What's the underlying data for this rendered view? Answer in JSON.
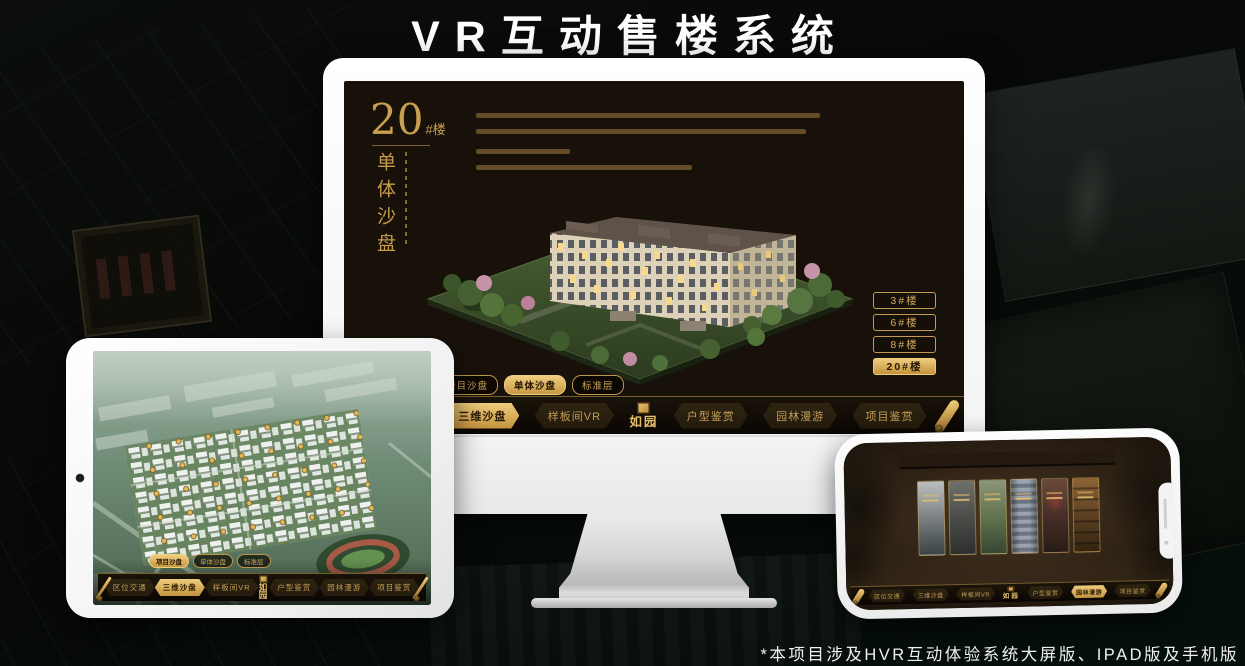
{
  "title": "VR互动售楼系统",
  "footnote": "*本项目涉及HVR互动体验系统大屏版、IPAD版及手机版",
  "brand": {
    "logo_text": "如园"
  },
  "colors": {
    "gold": "#c9a050",
    "gold_bright": "#eecb7d",
    "screen_bg": "#18110a",
    "device_frame": "#f5f5f5"
  },
  "desktop": {
    "headline": {
      "number": "20",
      "suffix": "#楼",
      "subtitle": "单体沙盘"
    },
    "floor_buttons": [
      {
        "label": "3#楼",
        "active": false
      },
      {
        "label": "6#楼",
        "active": false
      },
      {
        "label": "8#楼",
        "active": false
      },
      {
        "label": "20#楼",
        "active": true
      }
    ],
    "view_tabs": [
      {
        "label": "项目沙盘",
        "active": false
      },
      {
        "label": "单体沙盘",
        "active": true
      },
      {
        "label": "标准层",
        "active": false
      }
    ],
    "nav_left": [
      {
        "label": "区位交通",
        "active": false
      },
      {
        "label": "三维沙盘",
        "active": true
      },
      {
        "label": "样板间VR",
        "active": false
      }
    ],
    "nav_right": [
      {
        "label": "户型鉴赏",
        "active": false
      },
      {
        "label": "园林漫游",
        "active": false
      },
      {
        "label": "项目鉴赏",
        "active": false
      }
    ]
  },
  "tablet": {
    "view_tabs": [
      {
        "label": "项目沙盘",
        "active": true
      },
      {
        "label": "单体沙盘",
        "active": false
      },
      {
        "label": "标准层",
        "active": false
      }
    ],
    "nav_left": [
      {
        "label": "区位交通",
        "active": false
      },
      {
        "label": "三维沙盘",
        "active": true
      },
      {
        "label": "样板间VR",
        "active": false
      }
    ],
    "nav_right": [
      {
        "label": "户型鉴赏",
        "active": false
      },
      {
        "label": "园林漫游",
        "active": false
      },
      {
        "label": "项目鉴赏",
        "active": false
      }
    ]
  },
  "phone": {
    "nav_left": [
      {
        "label": "区位交通",
        "active": false
      },
      {
        "label": "三维沙盘",
        "active": false
      },
      {
        "label": "样板间VR",
        "active": false
      }
    ],
    "nav_right": [
      {
        "label": "户型鉴赏",
        "active": false
      },
      {
        "label": "园林漫游",
        "active": true
      },
      {
        "label": "项目鉴赏",
        "active": false
      }
    ]
  }
}
